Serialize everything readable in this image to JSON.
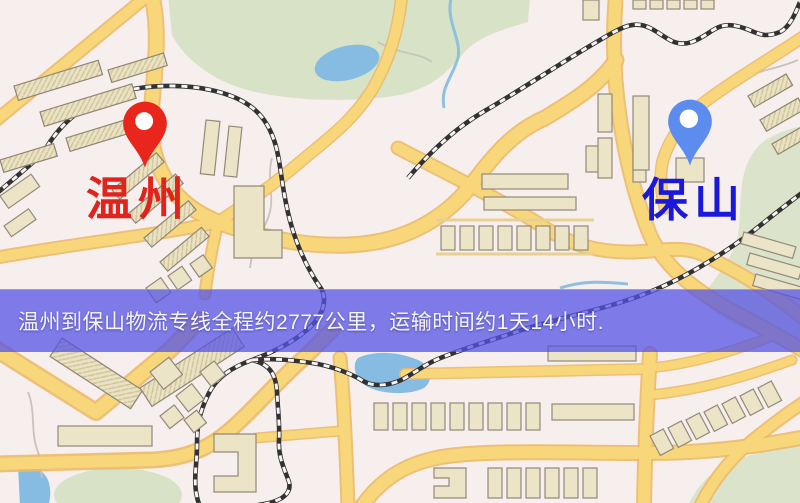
{
  "banner": {
    "text": "温州到保山物流专线全程约2777公里，运输时间约1天14小时.",
    "background_color": "rgba(86,83,228,0.75)",
    "text_color": "#f7f5f1",
    "route": {
      "origin": "温州",
      "destination": "保山",
      "distance_km": "2777",
      "duration": "1天14小时"
    }
  },
  "map": {
    "kind": "street-map illustration",
    "markers": [
      {
        "id": "origin",
        "label": "温州",
        "pin_color": "#e8261b",
        "pin_icon": "map-pin",
        "label_color": "#e0231c"
      },
      {
        "id": "destination",
        "label": "保山",
        "pin_color": "#5b8cee",
        "pin_icon": "map-pin",
        "label_color": "#1b18d9"
      }
    ],
    "palette": {
      "base": "#f6efee",
      "road_fill": "#f8d77b",
      "road_casing": "#edb968",
      "building": "#ece4c6",
      "park_green": "#d7e2c6",
      "water_blue": "#86bbe2",
      "railway_dark": "#333233"
    }
  }
}
